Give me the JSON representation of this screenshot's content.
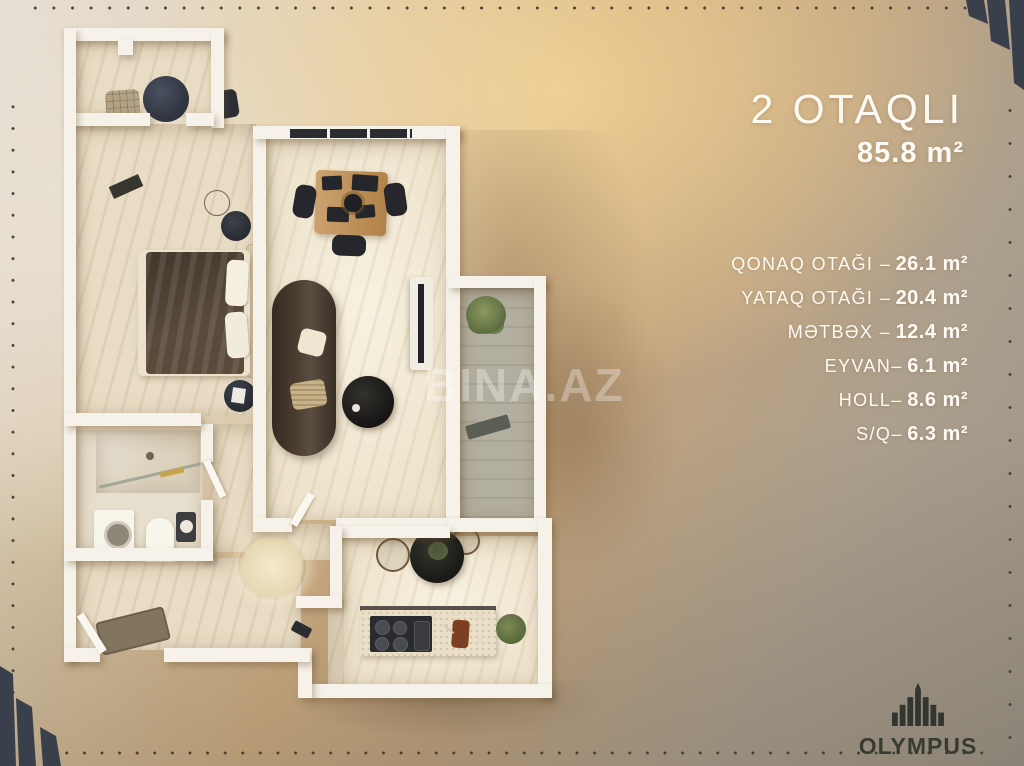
{
  "header": {
    "title": "2 OTAQLI",
    "area": "85.8 m²"
  },
  "room_list": [
    {
      "label": "QONAQ OTAĞI –",
      "value": "26.1 m²"
    },
    {
      "label": "YATAQ OTAĞI –",
      "value": "20.4 m²"
    },
    {
      "label": "MƏTBƏX –",
      "value": "12.4 m²"
    },
    {
      "label": "EYVAN–",
      "value": "6.1 m²"
    },
    {
      "label": "HOLL–",
      "value": "8.6 m²"
    },
    {
      "label": "S/Q–",
      "value": "6.3 m²"
    }
  ],
  "watermark": "BINA.AZ",
  "brand": "OLYMPUS",
  "colors": {
    "background_gold": "#d3ac76",
    "corner_navy": "#3a404b",
    "text_white": "#fdfaf5",
    "logo_dark": "#32362f",
    "wall_white": "#f6f2e9"
  }
}
